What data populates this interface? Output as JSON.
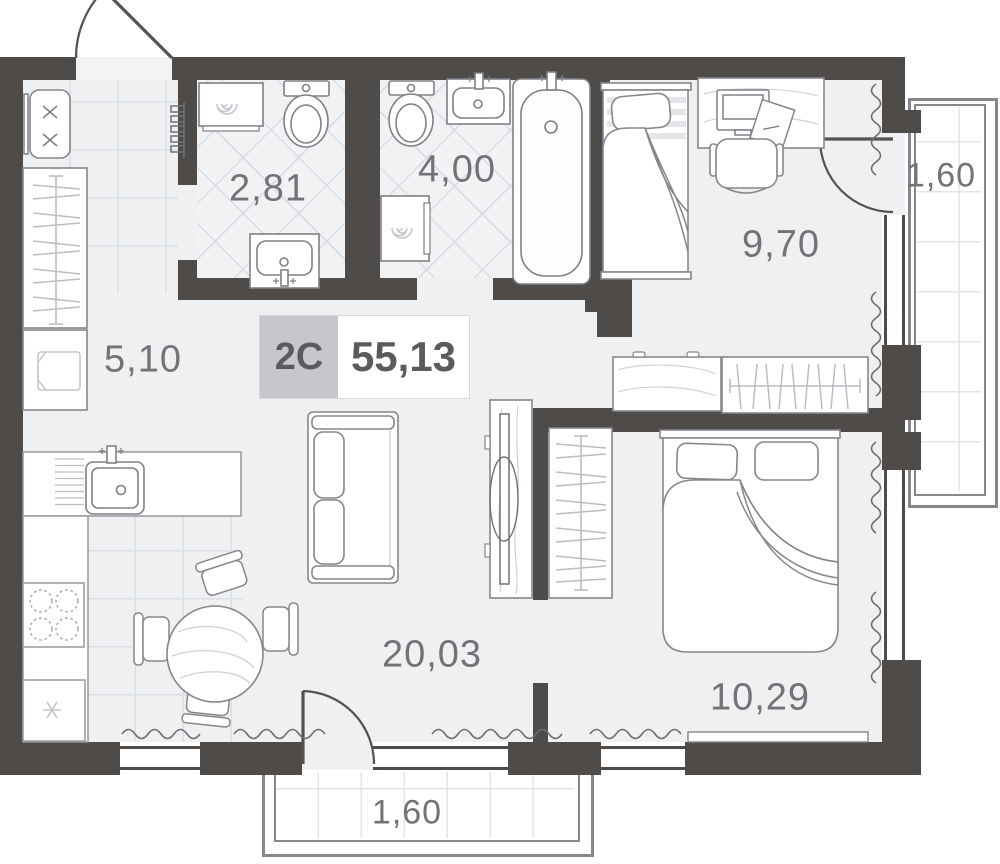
{
  "title": "Apartment floor plan",
  "badge": {
    "unit_type": "2C",
    "total_area": "55,13"
  },
  "rooms": {
    "hallway": {
      "name": "hallway",
      "area": "5,10"
    },
    "bathroom_small": {
      "name": "bathroom",
      "area": "2,81"
    },
    "bathroom_large": {
      "name": "bathroom",
      "area": "4,00"
    },
    "bedroom_small": {
      "name": "bedroom",
      "area": "9,70"
    },
    "balcony_right": {
      "name": "balcony",
      "area": "1,60"
    },
    "living_kitchen": {
      "name": "kitchen-living room",
      "area": "20,03"
    },
    "bedroom_large": {
      "name": "bedroom",
      "area": "10,29"
    },
    "balcony_bottom": {
      "name": "balcony",
      "area": "1,60"
    }
  },
  "icons": {
    "washing_machine": "spiral",
    "freezer": "snowflake",
    "stove": "four-burner-circles",
    "entry_bench": "x-marks"
  },
  "colors": {
    "wall": "#4e4b49",
    "floor": "#eff0f2",
    "tile_line": "#dcdfe4",
    "badge_bg": "#c7c6ca",
    "label_text": "#727377",
    "furniture_line": "#85878c"
  }
}
